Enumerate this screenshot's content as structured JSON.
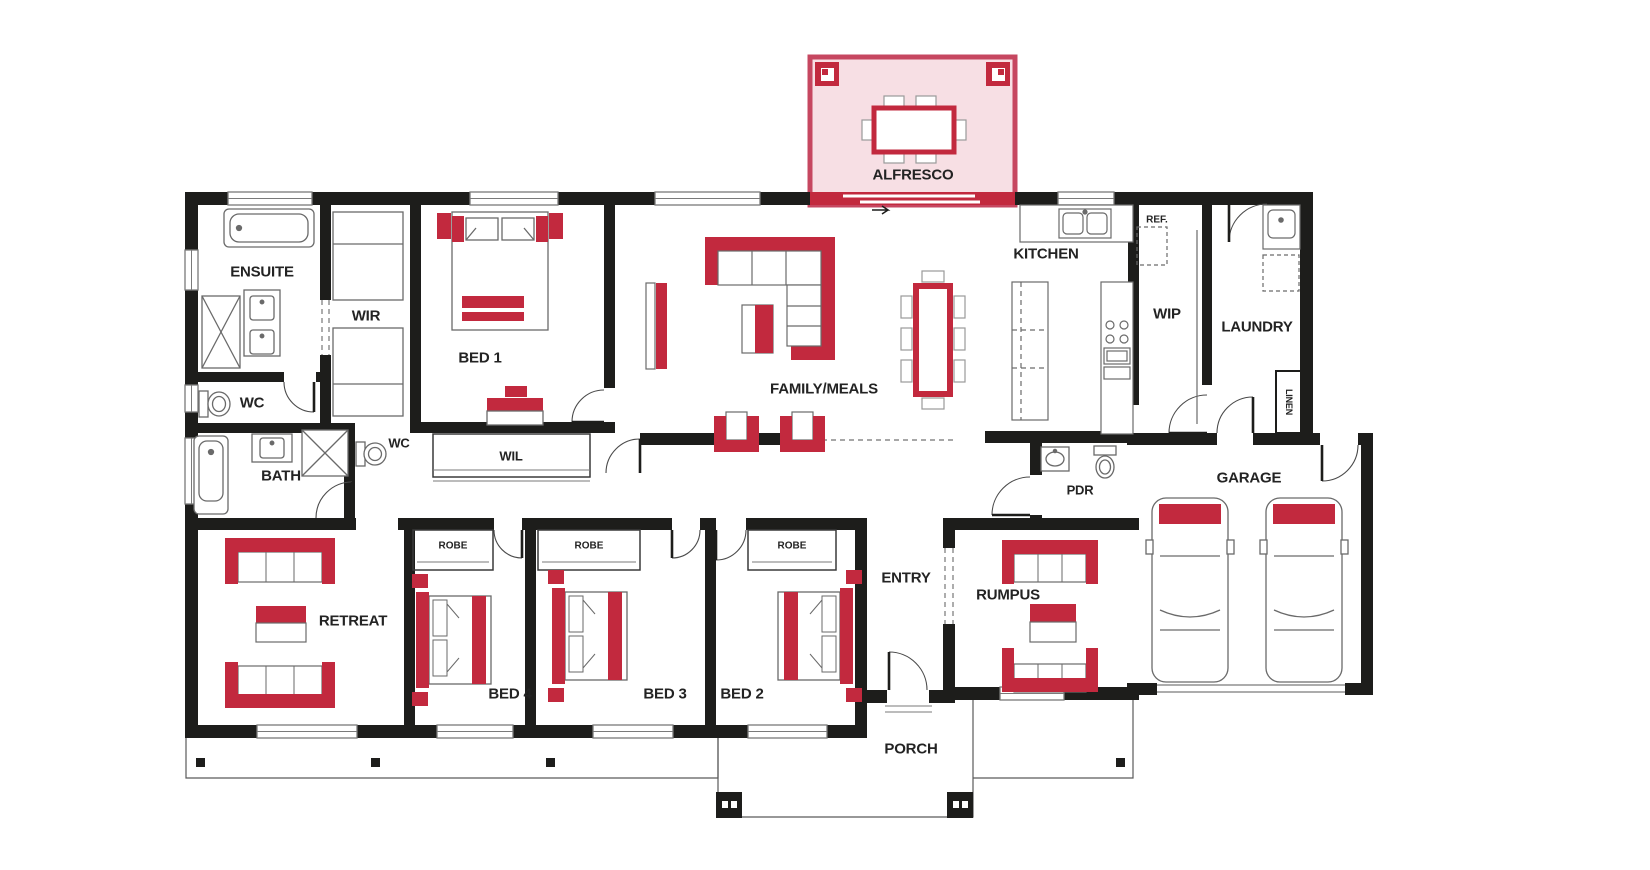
{
  "colors": {
    "wall_black": "#1d1d1b",
    "accent_red": "#c2293e",
    "alfresco_fill": "#f7dfe4",
    "alfresco_border": "#c64760",
    "outline_gray": "#6a6a6a"
  },
  "labels": {
    "alfresco": "ALFRESCO",
    "ensuite": "ENSUITE",
    "wc_ensuite": "WC",
    "wir": "WIR",
    "bed1": "BED 1",
    "family": "FAMILY/MEALS",
    "kitchen": "KITCHEN",
    "ref": "REF.",
    "wip": "WIP",
    "laundry": "LAUNDRY",
    "linen": "LINEN",
    "bath": "BATH",
    "wc_bath": "WC",
    "wil": "WIL",
    "retreat": "RETREAT",
    "robe_bed4": "ROBE",
    "robe_bed3": "ROBE",
    "robe_bed2": "ROBE",
    "bed4": "BED 4",
    "bed3": "BED 3",
    "bed2": "BED 2",
    "entry": "ENTRY",
    "rumpus": "RUMPUS",
    "pdr": "PDR",
    "garage": "GARAGE",
    "porch": "PORCH"
  }
}
